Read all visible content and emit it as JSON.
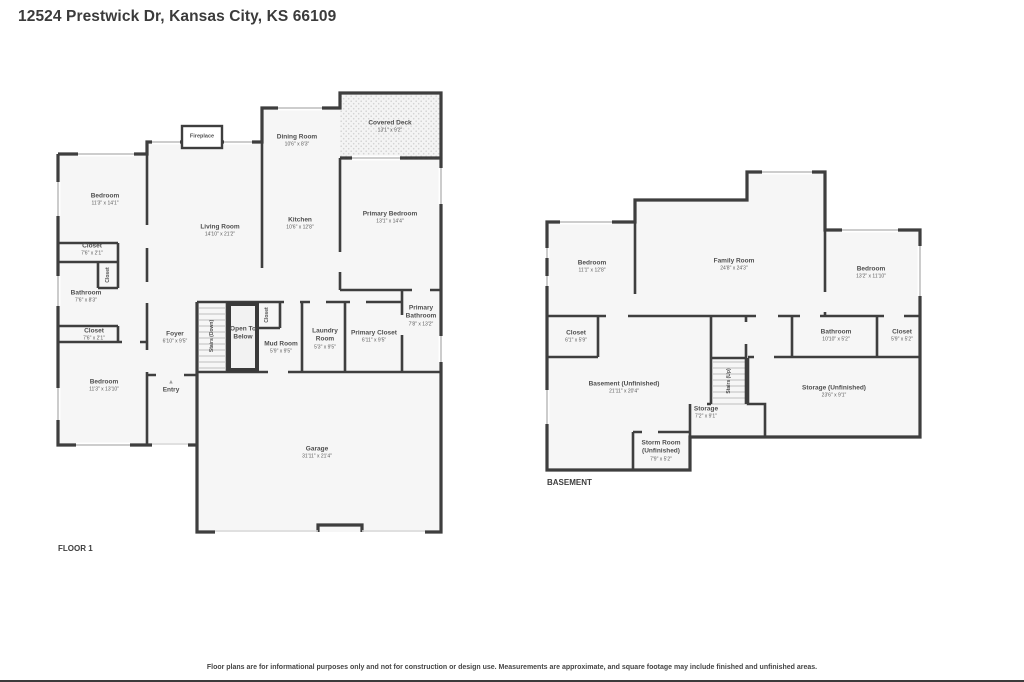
{
  "page": {
    "title": "12524 Prestwick Dr, Kansas City, KS 66109",
    "disclaimer": "Floor plans are for informational purposes only and not for construction or design use. Measurements are approximate, and square footage may include finished and unfinished areas.",
    "wall_color": "#3e3e3e",
    "room_fill": "#f6f6f6"
  },
  "floor1": {
    "label": "FLOOR 1",
    "entry_arrow": "▲",
    "rooms": {
      "bedroom1": {
        "name": "Bedroom",
        "dims": "11'3\" x 14'1\""
      },
      "closet1": {
        "name": "Closet",
        "dims": "7'6\" x 2'1\""
      },
      "closet_small": {
        "name": "Closet"
      },
      "bathroom": {
        "name": "Bathroom",
        "dims": "7'6\" x 8'3\""
      },
      "closet2": {
        "name": "Closet",
        "dims": "7'6\" x 2'1\""
      },
      "bedroom2": {
        "name": "Bedroom",
        "dims": "11'3\" x 13'10\""
      },
      "foyer": {
        "name": "Foyer",
        "dims": "6'10\" x 9'5\""
      },
      "entry": {
        "name": "Entry"
      },
      "stairs_down": {
        "name": "Stairs (Down)"
      },
      "open_to_below": {
        "name": "Open To Below"
      },
      "closet_mid": {
        "name": "Closet"
      },
      "mud_room": {
        "name": "Mud Room",
        "dims": "5'9\" x 9'5\""
      },
      "laundry_room": {
        "name": "Laundry Room",
        "dims": "5'3\" x 9'5\""
      },
      "primary_closet": {
        "name": "Primary Closet",
        "dims": "6'11\" x 9'5\""
      },
      "primary_bathroom": {
        "name": "Primary Bathroom",
        "dims": "7'8\" x 13'2\""
      },
      "living_room": {
        "name": "Living Room",
        "dims": "14'10\" x 21'2\""
      },
      "kitchen": {
        "name": "Kitchen",
        "dims": "10'6\" x 12'8\""
      },
      "dining_room": {
        "name": "Dining Room",
        "dims": "10'6\" x 8'3\""
      },
      "primary_bedroom": {
        "name": "Primary Bedroom",
        "dims": "13'1\" x 14'4\""
      },
      "covered_deck": {
        "name": "Covered Deck",
        "dims": "13'1\" x 9'2\""
      },
      "garage": {
        "name": "Garage",
        "dims": "31'11\" x 21'4\""
      },
      "fireplace": {
        "name": "Fireplace"
      }
    }
  },
  "basement": {
    "label": "BASEMENT",
    "rooms": {
      "bedroom_left": {
        "name": "Bedroom",
        "dims": "11'1\" x 12'8\""
      },
      "family_room": {
        "name": "Family Room",
        "dims": "24'8\" x 24'3\""
      },
      "bedroom_right": {
        "name": "Bedroom",
        "dims": "13'2\" x 11'10\""
      },
      "closet_left": {
        "name": "Closet",
        "dims": "6'1\" x 5'9\""
      },
      "bathroom": {
        "name": "Bathroom",
        "dims": "10'10\" x 5'2\""
      },
      "closet_right": {
        "name": "Closet",
        "dims": "5'9\" x 5'2\""
      },
      "basement_unfinished": {
        "name": "Basement (Unfinished)",
        "dims": "21'11\" x 20'4\""
      },
      "stairs_up": {
        "name": "Stairs (Up)"
      },
      "storage": {
        "name": "Storage",
        "dims": "7'2\" x 9'1\""
      },
      "storm_room": {
        "name": "Storm Room (Unfinished)",
        "dims": "7'9\" x 5'2\""
      },
      "storage_unfinished": {
        "name": "Storage (Unfinished)",
        "dims": "23'6\" x 9'1\""
      }
    }
  }
}
